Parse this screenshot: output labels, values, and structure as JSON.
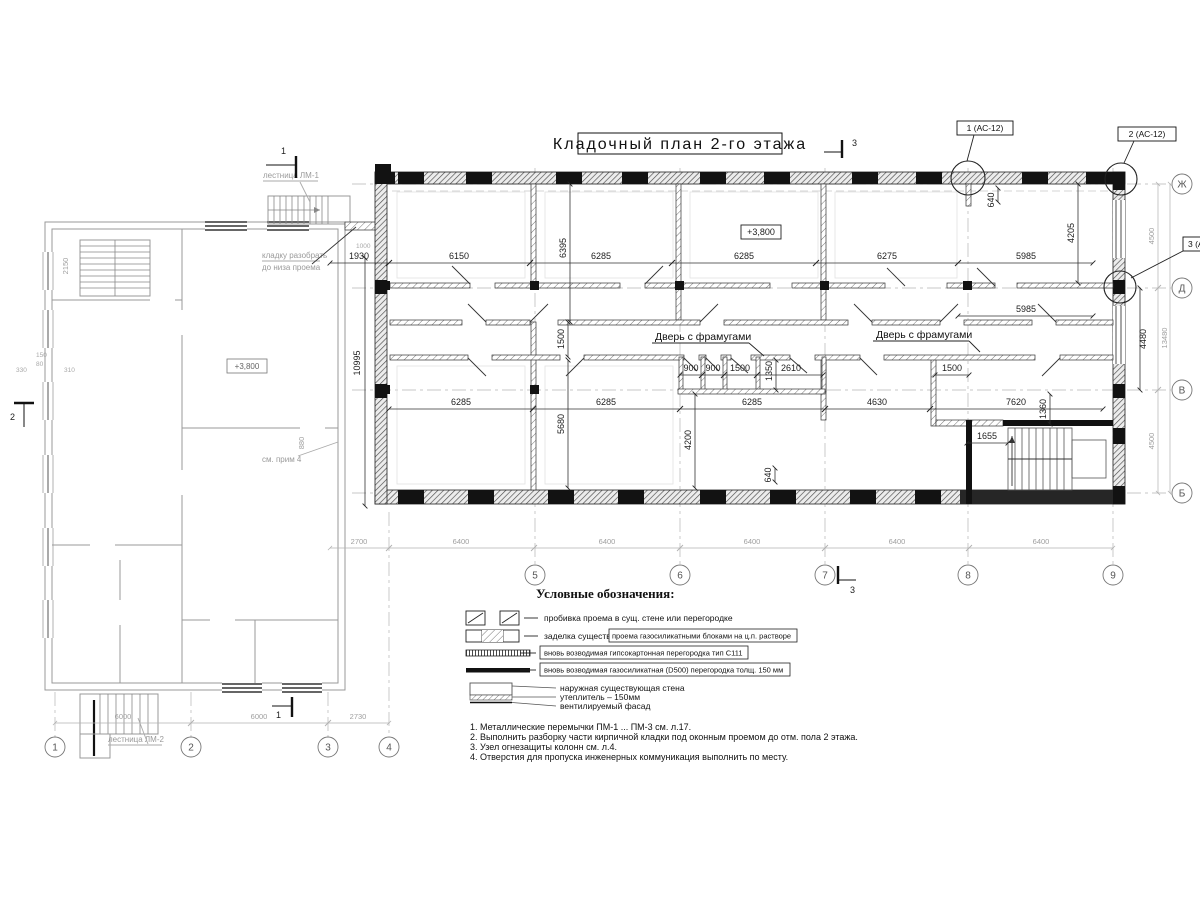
{
  "title": "Кладочный план 2-го этажа",
  "level_main": "+3,800",
  "level_left": "+3,800",
  "marks": {
    "top_left": "1",
    "left": "2",
    "title": "3",
    "bottom_center": "3",
    "bottom_left": "1"
  },
  "callouts": {
    "c1": "1 (АС-12)",
    "c2": "2 (АС-12)",
    "c3": "3 (АС-12)"
  },
  "labels": {
    "door_left": "Дверь с фрамугами",
    "door_right": "Дверь с фрамугами",
    "stair_top": "лестница ЛМ-1",
    "stair_bottom": "лестница ЛМ-2",
    "demolish1": "кладку разобрать",
    "demolish2": "до низа проема",
    "see_note": "см. прим 4"
  },
  "axes": {
    "bottom_main": [
      "5",
      "6",
      "7",
      "8",
      "9"
    ],
    "bottom_left": [
      "1",
      "2",
      "3",
      "4"
    ],
    "right": [
      "Ж",
      "Д",
      "В",
      "Б"
    ]
  },
  "dims": {
    "top_row": [
      "1930",
      "6150",
      "6285",
      "6285",
      "6275",
      "5985"
    ],
    "second_5985": "5985",
    "v6395": "6395",
    "v640_top": "640",
    "v4205": "4205",
    "v4480": "4480",
    "v10995": "10995",
    "v1500": "1500",
    "v5680": "5680",
    "v4200": "4200",
    "v640_bot": "640",
    "v1350": "1350",
    "v1360": "1360",
    "wc_row": [
      "900",
      "900",
      "1500",
      "2610"
    ],
    "right_1500": "1500",
    "mid_row": [
      "6285",
      "6285",
      "6285",
      "4630",
      "7620"
    ],
    "d1655": "1655",
    "d1000": "1000",
    "grid_row": [
      "2700",
      "6400",
      "6400",
      "6400",
      "6400",
      "6400"
    ],
    "right_col": [
      "4500",
      "4500"
    ],
    "right_total": "13480",
    "left_row": [
      "6000",
      "6000",
      "2730"
    ],
    "left_small": [
      "150",
      "80",
      "330",
      "310"
    ],
    "v2150": "2150",
    "v880": "880"
  },
  "legend": {
    "heading": "Условные обозначения:",
    "r1": "пробивка проема  в сущ. стене  или перегородке",
    "r2a": "заделка существ.",
    "r2b": "проема газосиликатными блоками на ц.п. растворе",
    "r3": "вновь возводимая гипсокартонная перегородка тип С111",
    "r4": "вновь возводимая газосиликатная (D500) перегородка толщ. 150 мм",
    "r5a": "наружная существующая стена",
    "r5b": "утеплитель – 150мм",
    "r5c": "вентилируемый фасад"
  },
  "notes": [
    "1. Металлические перемычки  ПМ-1 ... ПМ-3  см. л.17.",
    "2. Выполнить разборку части кирпичной кладки под оконным проемом до отм. пола 2 этажа.",
    "3. Узел огнезащиты колонн см. л.4.",
    "4. Отверстия для пропуска инженерных коммуникация выполнить по месту."
  ]
}
